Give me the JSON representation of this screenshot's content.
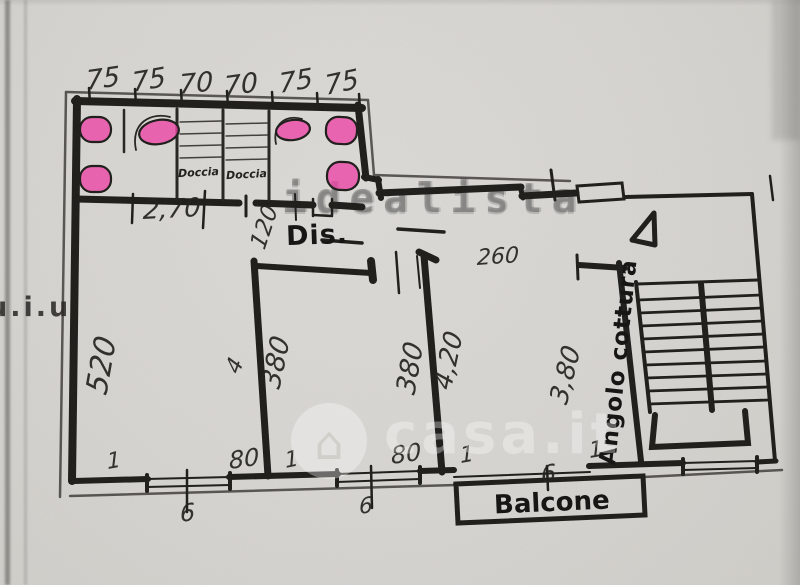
{
  "palette": {
    "paper": "#d7d5d1",
    "ink": "#1b1a17",
    "pink_highlight": "#ef3fa5",
    "watermark_gray": "#6e6e6c"
  },
  "labels": {
    "hall": "Dis.",
    "balcony": "Balcone",
    "kitchen": "Angolo cottura",
    "shower_left": "Doccia",
    "shower_right": "Doccia",
    "stamp": "u.i.u"
  },
  "watermarks": {
    "brand_top": "idealista",
    "brand_center": "casa.it",
    "house_glyph": "⌂"
  },
  "annotations": [
    {
      "t": "75",
      "x": 86,
      "y": 66,
      "r": -8,
      "s": 27
    },
    {
      "t": "75",
      "x": 132,
      "y": 68,
      "r": -10,
      "s": 27
    },
    {
      "t": "70",
      "x": 179,
      "y": 70,
      "r": -6,
      "s": 27
    },
    {
      "t": "70",
      "x": 224,
      "y": 72,
      "r": -8,
      "s": 27
    },
    {
      "t": "75",
      "x": 279,
      "y": 69,
      "r": -10,
      "s": 27
    },
    {
      "t": "75",
      "x": 325,
      "y": 71,
      "r": -12,
      "s": 27
    },
    {
      "t": "2,70",
      "x": 143,
      "y": 196,
      "r": -3,
      "s": 26
    },
    {
      "t": "120",
      "x": 258,
      "y": 235,
      "r": -72,
      "s": 23
    },
    {
      "t": "260",
      "x": 477,
      "y": 246,
      "r": -4,
      "s": 22
    },
    {
      "t": "520",
      "x": 97,
      "y": 376,
      "r": -80,
      "s": 30
    },
    {
      "t": "4",
      "x": 233,
      "y": 360,
      "r": -70,
      "s": 22
    },
    {
      "t": "380",
      "x": 271,
      "y": 372,
      "r": -78,
      "s": 27
    },
    {
      "t": "380",
      "x": 406,
      "y": 378,
      "r": -80,
      "s": 27
    },
    {
      "t": "4,20",
      "x": 443,
      "y": 374,
      "r": -78,
      "s": 26
    },
    {
      "t": "3,80",
      "x": 559,
      "y": 388,
      "r": -76,
      "s": 26
    },
    {
      "t": "1",
      "x": 107,
      "y": 450,
      "r": -10,
      "s": 22
    },
    {
      "t": "6",
      "x": 180,
      "y": 500,
      "r": -8,
      "s": 24
    },
    {
      "t": "80",
      "x": 229,
      "y": 447,
      "r": -8,
      "s": 24
    },
    {
      "t": "1",
      "x": 285,
      "y": 449,
      "r": -12,
      "s": 22
    },
    {
      "t": "6",
      "x": 359,
      "y": 495,
      "r": -8,
      "s": 22
    },
    {
      "t": "80",
      "x": 391,
      "y": 442,
      "r": -8,
      "s": 24
    },
    {
      "t": "1",
      "x": 460,
      "y": 444,
      "r": -10,
      "s": 22
    },
    {
      "t": "6",
      "x": 541,
      "y": 461,
      "r": -8,
      "s": 24
    },
    {
      "t": "1",
      "x": 589,
      "y": 439,
      "r": -10,
      "s": 22
    }
  ]
}
